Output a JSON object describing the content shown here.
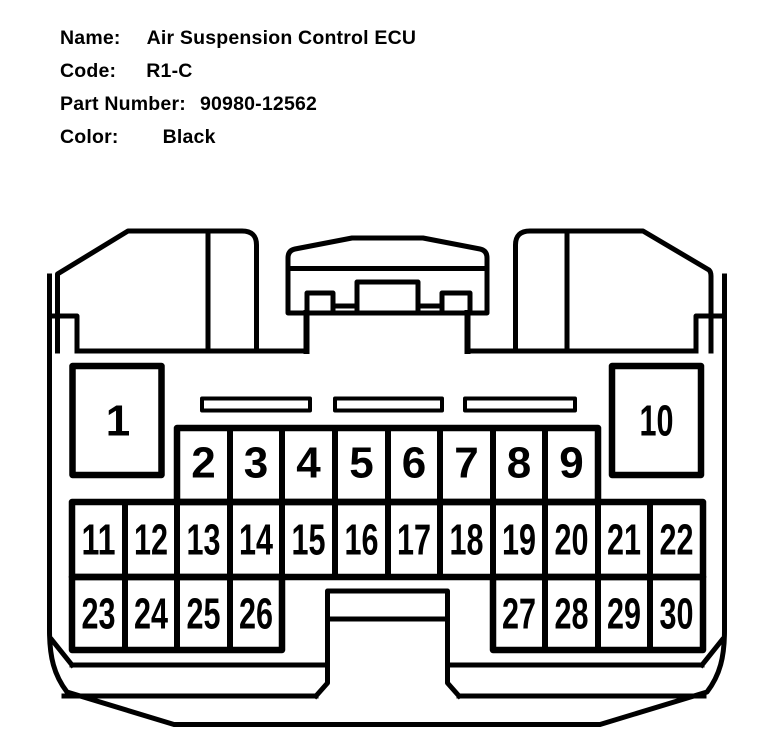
{
  "header": {
    "fields": [
      {
        "label": "Name:",
        "value": "Air Suspension Control ECU"
      },
      {
        "label": "Code:",
        "value": "R1-C"
      },
      {
        "label": "Part Number:",
        "value": "90980-12562"
      },
      {
        "label": "Color:",
        "value": "Black"
      }
    ]
  },
  "connector": {
    "pins": [
      "1",
      "2",
      "3",
      "4",
      "5",
      "6",
      "7",
      "8",
      "9",
      "10",
      "11",
      "12",
      "13",
      "14",
      "15",
      "16",
      "17",
      "18",
      "19",
      "20",
      "21",
      "22",
      "23",
      "24",
      "25",
      "26",
      "27",
      "28",
      "29",
      "30"
    ],
    "line_color": "#000000",
    "background_color": "#ffffff"
  }
}
